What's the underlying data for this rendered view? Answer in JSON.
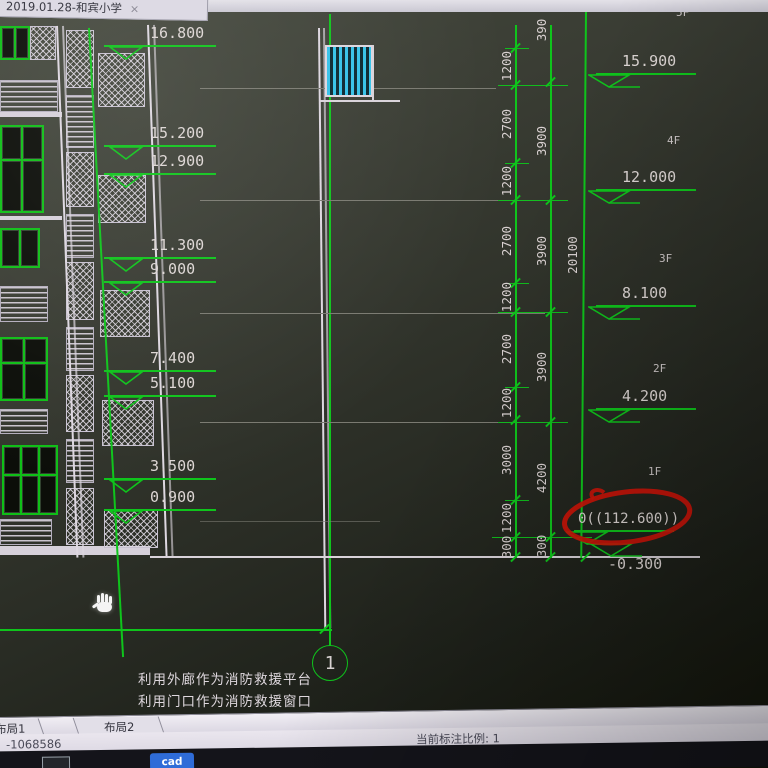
{
  "window": {
    "tab_title": "2019.01.28-和宾小学",
    "close_label": "×"
  },
  "drawing": {
    "levels_left": [
      "16.800",
      "15.200",
      "12.900",
      "11.300",
      "9.000",
      "7.400",
      "5.100",
      "3.500",
      "0.900"
    ],
    "levels_right": [
      "15.900",
      "12.000",
      "8.100",
      "4.200",
      "0((112.600))",
      "-0.300"
    ],
    "floors": [
      "5F",
      "4F",
      "3F",
      "2F",
      "1F"
    ],
    "dims_inner": [
      "1200",
      "2700",
      "1200",
      "2700",
      "1200",
      "2700",
      "1200",
      "3000",
      "1200",
      "300"
    ],
    "dims_mid": [
      "390",
      "3900",
      "3900",
      "3900",
      "4200",
      "300"
    ],
    "dim_total": "20100",
    "axis_bubble": "1",
    "notes": [
      "利用外廊作为消防救援平台",
      "利用门口作为消防救援窗口"
    ]
  },
  "layout_tabs": [
    "布局1",
    "布局2"
  ],
  "statusbar": {
    "coordinates": "-1068586",
    "annotation_scale": "当前标注比例: 1"
  },
  "taskbar": {
    "cad_icon_label": "cad"
  },
  "colors": {
    "line_green": "#0fc41c",
    "text_light": "#ddd6d4",
    "annotation_red": "#cf1408",
    "grille_blue": "#35c2e8"
  }
}
